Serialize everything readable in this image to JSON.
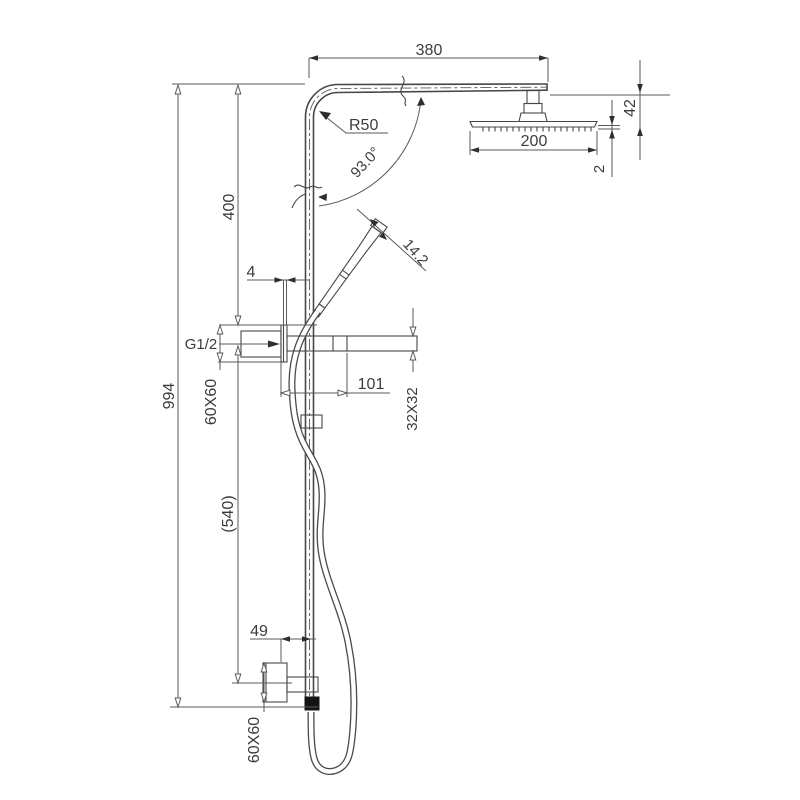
{
  "drawing": {
    "type": "technical-dimension-drawing",
    "subject": "wall-mounted shower column with overhead rain head and hand shower",
    "colors": {
      "background": "#ffffff",
      "object_line": "#474747",
      "dimension_line": "#5a5a5a",
      "text": "#3c3c3c",
      "hose_nut_fill": "#141414"
    }
  },
  "dims": {
    "arm_length": "380",
    "corner_radius": "R50",
    "head_width": "200",
    "head_drop": "42",
    "head_plate_thickness": "2",
    "angle": "93.0°",
    "handset_diameter": "14.2",
    "upper_height": "400",
    "gap": "4",
    "inlet": "G1/2",
    "total_height": "994",
    "upper_bracket": "60X60",
    "wall_offset": "101",
    "rail_section": "32X32",
    "bracket_span": "(540)",
    "lower_offset": "49",
    "lower_bracket": "60X60"
  }
}
